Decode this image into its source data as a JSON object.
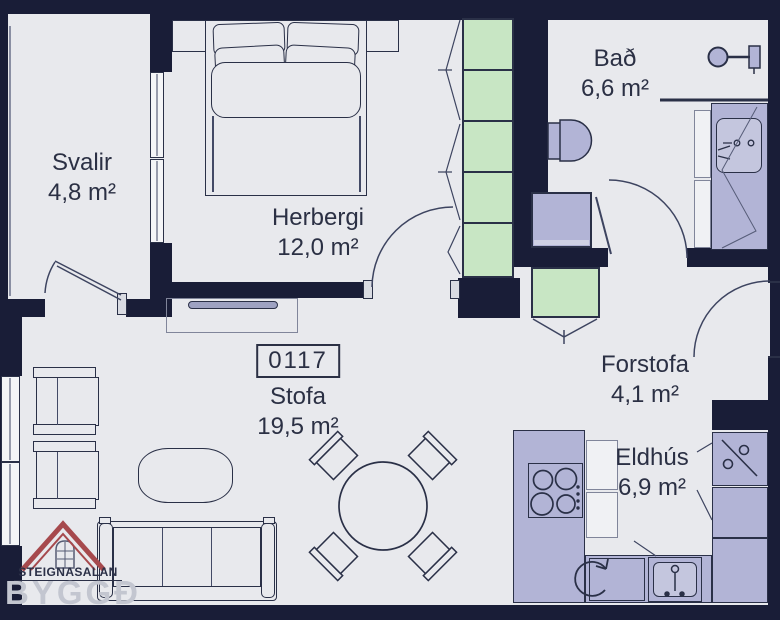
{
  "unit": {
    "number": "0117"
  },
  "rooms": {
    "svalir": {
      "name": "Svalir",
      "area": "4,8 m²"
    },
    "herbergi": {
      "name": "Herbergi",
      "area": "12,0 m²"
    },
    "bad": {
      "name": "Bað",
      "area": "6,6 m²"
    },
    "forstofa": {
      "name": "Forstofa",
      "area": "4,1 m²"
    },
    "eldhus": {
      "name": "Eldhús",
      "area": "6,9 m²"
    },
    "stofa": {
      "name": "Stofa",
      "area": "19,5 m²"
    }
  },
  "logo": {
    "agency_name": "STEIGNASALAN",
    "brand_name": "BYGGÐ"
  },
  "fixtures": [
    "double-bed",
    "nightstands",
    "wardrobe",
    "tv",
    "sofa",
    "armchairs",
    "coffee-table",
    "dining-table",
    "toilet",
    "shower",
    "vanity-sink",
    "washing-machine",
    "hall-closet",
    "cooktop",
    "kitchen-sink",
    "dishwasher",
    "fridge"
  ],
  "colors": {
    "wall": "#191d37",
    "floor": "#e8e9ed",
    "fixture_lavender": "#b2b4d6",
    "wardrobe_green": "#c8e6c4",
    "line_navy": "#2a3047",
    "roof_red": "#a6494d",
    "text": "#2b3044",
    "watermark": "#c3c6d0"
  }
}
